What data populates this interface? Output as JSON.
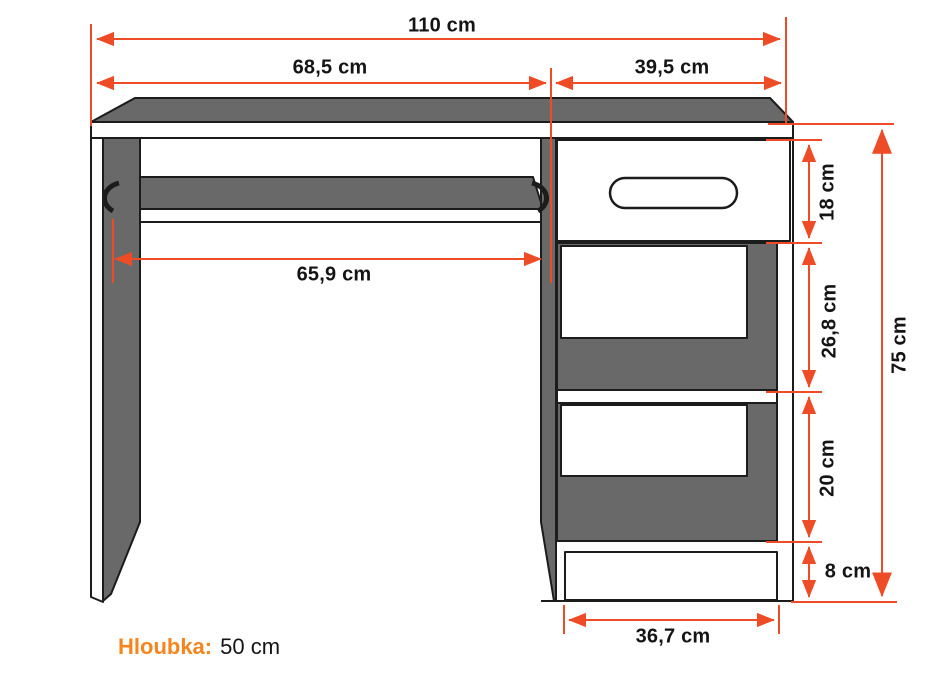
{
  "diagram": {
    "type": "furniture-dimension-drawing",
    "dimensions": {
      "width_total": "110 cm",
      "width_left": "68,5 cm",
      "width_right": "39,5 cm",
      "tray_width": "65,9 cm",
      "drawer_height": "18 cm",
      "upper_niche_height": "26,8 cm",
      "lower_niche_height": "20 cm",
      "plinth_height": "8 cm",
      "total_height": "75 cm",
      "plinth_width": "36,7 cm"
    },
    "depth": {
      "label": "Hloubka:",
      "value": "50 cm"
    },
    "colors": {
      "dimension_accent": "#ee4c26",
      "depth_label_orange": "#f5861f",
      "panel_gray": "#696969",
      "outline": "#1c1c1c",
      "background": "#ffffff"
    }
  }
}
